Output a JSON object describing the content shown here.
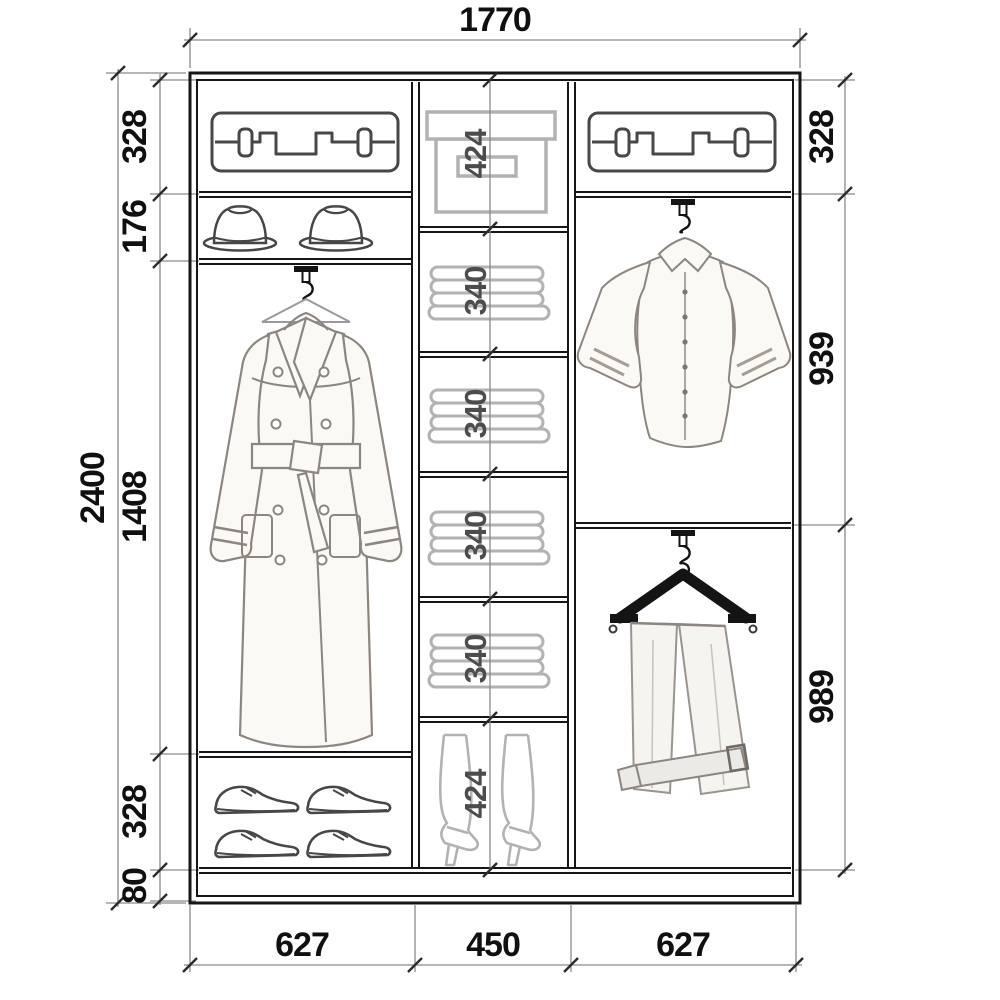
{
  "diagram": {
    "kind": "wardrobe interior elevation drawing",
    "dimensions": {
      "top": "1770",
      "left_outer": "2400",
      "left_inner": [
        "328",
        "176",
        "1408",
        "328",
        "80"
      ],
      "middle": [
        "424",
        "340",
        "340",
        "340",
        "340",
        "424"
      ],
      "right": [
        "328",
        "939",
        "989"
      ],
      "bottom": [
        "627",
        "450",
        "627"
      ]
    },
    "columns": [
      {
        "width": "627",
        "sections": [
          {
            "height": "328",
            "content": "suitcase"
          },
          {
            "height": "176",
            "content": "two hats"
          },
          {
            "height": "1408",
            "content": "trench coat on hanger rod"
          },
          {
            "height": "328",
            "content": "four dress shoes"
          },
          {
            "height": "80",
            "content": "base plinth"
          }
        ]
      },
      {
        "width": "450",
        "sections": [
          {
            "height": "424",
            "content": "storage box"
          },
          {
            "height": "340",
            "content": "folded linen"
          },
          {
            "height": "340",
            "content": "folded linen"
          },
          {
            "height": "340",
            "content": "folded linen"
          },
          {
            "height": "340",
            "content": "folded linen"
          },
          {
            "height": "424",
            "content": "pair of high boots"
          }
        ]
      },
      {
        "width": "627",
        "sections": [
          {
            "height": "328",
            "content": "suitcase"
          },
          {
            "height": "939",
            "content": "shirt on hanger rod"
          },
          {
            "height": "989",
            "content": "trousers on wooden hanger"
          }
        ]
      }
    ],
    "icons": [
      "suitcase-icon",
      "fedora-hat-icon",
      "trench-coat-icon",
      "storage-box-icon",
      "folded-linen-icon",
      "boots-icon",
      "shirt-icon",
      "trousers-hanger-icon",
      "dress-shoe-icon",
      "hanger-hook-icon"
    ],
    "colors": {
      "ink": "#161616",
      "dim_line": "#8a8a8a",
      "light_icon": "#b2b2b2",
      "dark_icon": "#474747"
    }
  }
}
